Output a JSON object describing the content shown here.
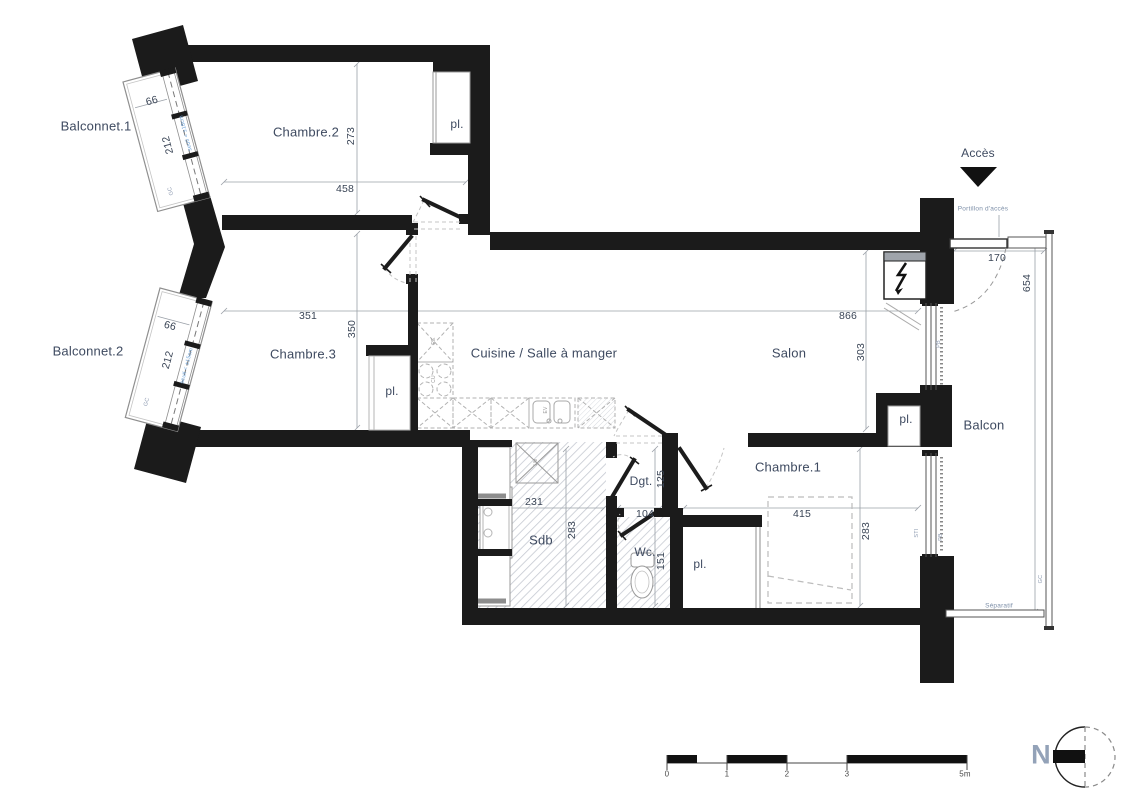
{
  "rooms": {
    "balconnet1": {
      "name": "Balconnet.1",
      "width": "66",
      "length": "212",
      "gc": "GC",
      "seuil": "seuil < ±18cm"
    },
    "balconnet2": {
      "name": "Balconnet.2",
      "width": "66",
      "length": "212",
      "gc": "GC",
      "seuil": "seuil < ±15cm"
    },
    "chambre2": {
      "name": "Chambre.2",
      "width": "458",
      "height": "273"
    },
    "chambre3": {
      "name": "Chambre.3",
      "width": "351",
      "height": "350"
    },
    "cuisine": {
      "name": "Cuisine / Salle à manger"
    },
    "salon": {
      "name": "Salon",
      "width": "866",
      "height": "303"
    },
    "chambre1": {
      "name": "Chambre.1",
      "width": "415",
      "height": "283"
    },
    "sdb": {
      "name": "Sdb",
      "width": "231",
      "height": "283"
    },
    "dgt": {
      "name": "Dgt.",
      "width": "104",
      "height": "125"
    },
    "wc": {
      "name": "Wc.",
      "height": "151"
    },
    "balcon": {
      "name": "Balcon",
      "width": "170",
      "height": "654",
      "gc": "GC",
      "separatif": "Séparatif"
    },
    "placard": "pl."
  },
  "access": {
    "label": "Accès",
    "portillon": "Portillon d'accès"
  },
  "tech": {
    "pb": "PB",
    "sti": "STI",
    "re": "RE",
    "cu": "CU",
    "ev": "EV",
    "lm": "LM"
  },
  "scalebar": {
    "t0": "0",
    "t1": "1",
    "t2": "2",
    "t3": "3",
    "t5": "5m"
  },
  "compass": {
    "north": "N"
  },
  "colors": {
    "wall": "#1b1b1b",
    "label": "#3e4a60",
    "annotation_blue": "#6fa3d8"
  }
}
